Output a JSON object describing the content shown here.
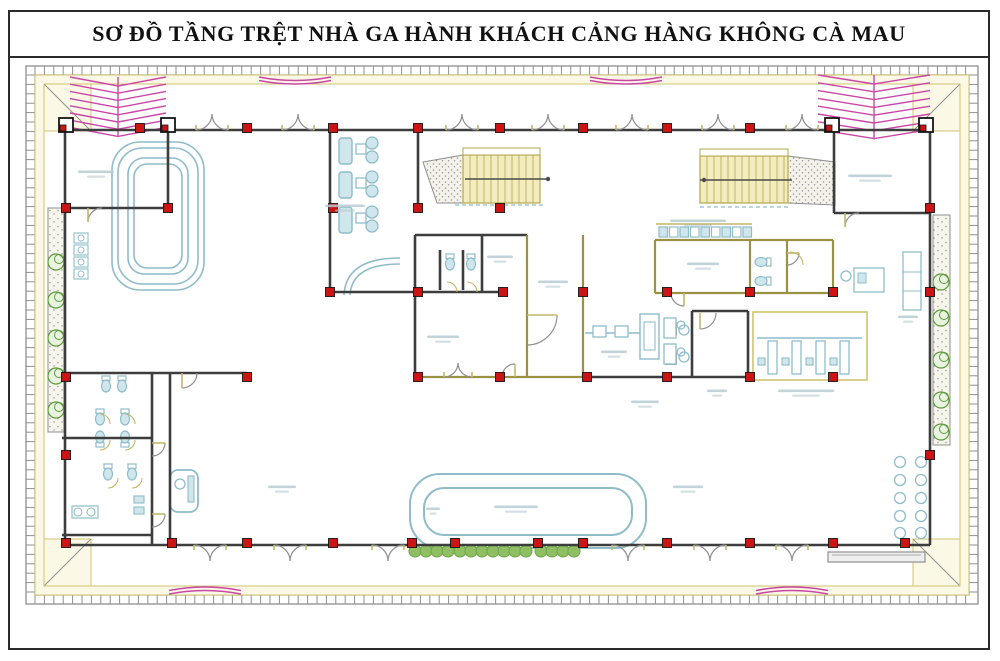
{
  "title": "SƠ ĐỒ TẦNG TRỆT NHÀ GA HÀNH KHÁCH CẢNG HÀNG KHÔNG CÀ MAU",
  "notes": {
    "room_labels_legible": false
  },
  "palette": {
    "ink": "#2b2b2b",
    "wall": "#3d3d3d",
    "wall_olive": "#9a9143",
    "column_fill": "#cc1414",
    "column_edge": "#151515",
    "furniture": "#8fbcc9",
    "furniture_fill": "#cfe6ec",
    "stair_fill": "#f2ecbe",
    "stair_edge": "#b3a74e",
    "cream_fill": "#fbf8e6",
    "cream_edge": "#cfc46e",
    "band_gray": "#8f8f8f",
    "canopy_pink": "#ca47a8",
    "plant_green": "#5d9a3c",
    "plant_fill": "#8fbe63",
    "shrub_green": "#6faa4a",
    "speckle_gray": "#9a9a9a",
    "door_gray": "#8f8f8f",
    "door_leaf": "#c2b86a",
    "label_smudge": "#b7ccd4"
  },
  "plan": {
    "band": {
      "outer": [
        26,
        66,
        952,
        538
      ],
      "thickness": 9,
      "tick_step": 9.4
    },
    "corner_boxes": [
      [
        35,
        75
      ],
      [
        913,
        75
      ],
      [
        35,
        539
      ],
      [
        913,
        539
      ]
    ],
    "cream_ring": {
      "outer": [
        35,
        75,
        934,
        520
      ],
      "inner": [
        44,
        84,
        916,
        502
      ]
    },
    "chevrons": [
      {
        "x1": 70,
        "x2": 166,
        "y0": 77,
        "rows": 8,
        "step": 7.2,
        "drop": 9
      },
      {
        "x1": 818,
        "x2": 930,
        "y0": 75,
        "rows": 8,
        "step": 7.8,
        "drop": 9
      }
    ],
    "pink_canopies": [
      {
        "cx": 295,
        "y": 77,
        "w": 72,
        "bulge": 7
      },
      {
        "cx": 626,
        "y": 77,
        "w": 72,
        "bulge": 7
      },
      {
        "cx": 205,
        "y": 594,
        "w": 72,
        "bulge": -7
      },
      {
        "cx": 792,
        "y": 594,
        "w": 72,
        "bulge": -7
      }
    ],
    "planters": [
      {
        "rect": [
          48,
          208,
          16,
          224
        ],
        "px": 56,
        "plant_ys": [
          262,
          300,
          338,
          376,
          410
        ]
      },
      {
        "rect": [
          933,
          215,
          17,
          230
        ],
        "px": 941,
        "plant_ys": [
          282,
          318,
          360,
          400,
          432
        ]
      }
    ],
    "shrub_rows": [
      {
        "x1": 415,
        "x2": 452,
        "y": 551
      },
      {
        "x1": 460,
        "x2": 533,
        "y": 551
      },
      {
        "x1": 541,
        "x2": 580,
        "y": 551
      }
    ],
    "walls_dark": [
      [
        65,
        130,
        930,
        130
      ],
      [
        65,
        545,
        930,
        545
      ],
      [
        65,
        130,
        65,
        545
      ],
      [
        930,
        130,
        930,
        545
      ],
      [
        168,
        130,
        168,
        208
      ],
      [
        65,
        208,
        168,
        208
      ],
      [
        330,
        130,
        330,
        292
      ],
      [
        418,
        130,
        418,
        208
      ],
      [
        330,
        292,
        503,
        292
      ],
      [
        415,
        235,
        527,
        235
      ],
      [
        415,
        235,
        415,
        377
      ],
      [
        482,
        235,
        482,
        292
      ],
      [
        440,
        250,
        440,
        290
      ],
      [
        463,
        250,
        463,
        290
      ],
      [
        62,
        373,
        247,
        373
      ],
      [
        152,
        373,
        152,
        545
      ],
      [
        170,
        373,
        170,
        545
      ],
      [
        62,
        438,
        152,
        438
      ],
      [
        62,
        535,
        152,
        535
      ],
      [
        834,
        130,
        834,
        213
      ],
      [
        834,
        213,
        930,
        213
      ],
      [
        692,
        311,
        692,
        377
      ],
      [
        748,
        311,
        748,
        377
      ],
      [
        692,
        311,
        748,
        311
      ],
      [
        587,
        377,
        748,
        377
      ]
    ],
    "walls_olive": [
      [
        527,
        235,
        527,
        377
      ],
      [
        583,
        235,
        583,
        377
      ],
      [
        415,
        377,
        587,
        377
      ],
      [
        655,
        240,
        833,
        240
      ],
      [
        655,
        240,
        655,
        293
      ],
      [
        750,
        240,
        750,
        293
      ],
      [
        787,
        240,
        787,
        293
      ],
      [
        833,
        240,
        833,
        293
      ],
      [
        655,
        293,
        833,
        293
      ]
    ],
    "yellow_box": [
      753,
      312,
      114,
      68
    ],
    "carousel_loops": [
      [
        112,
        142,
        92,
        148,
        28
      ],
      [
        118,
        148,
        80,
        136,
        24
      ],
      [
        128,
        158,
        60,
        116,
        16
      ],
      [
        134,
        164,
        48,
        104,
        13
      ]
    ],
    "canopy_loops": [
      [
        410,
        474,
        236,
        74,
        30
      ],
      [
        424,
        488,
        208,
        47,
        20
      ]
    ],
    "lounge_rail": [
      "M400,258 Q346,258 344,295",
      "M400,264 Q352,264 350,295"
    ],
    "stairs": [
      {
        "tread": [
          463,
          155,
          77,
          48
        ],
        "step": 7,
        "speck": "423,162 463,155 463,203 437,203",
        "rail": [
          465,
          179,
          548,
          179
        ],
        "dot": [
          548,
          179
        ],
        "top": [
          463,
          148,
          77,
          7
        ]
      },
      {
        "tread": [
          700,
          156,
          88,
          47
        ],
        "step": 7,
        "speck": "788,156 835,162 835,205 788,203",
        "rail": [
          700,
          180,
          792,
          180
        ],
        "dot": [
          704,
          180
        ],
        "top": [
          700,
          149,
          88,
          7
        ]
      }
    ],
    "stair_dash": [
      [
        455,
        205,
        545,
        205
      ],
      [
        700,
        207,
        790,
        207
      ]
    ],
    "doors_top": {
      "y": 130,
      "r": 16,
      "dir": -1,
      "xs": [
        212,
        298,
        462,
        548,
        632,
        718,
        802
      ]
    },
    "doors_bottom": {
      "y": 545,
      "r": 16,
      "dir": 1,
      "xs": [
        210,
        290,
        388,
        628,
        710,
        792
      ]
    },
    "doors_pair_internal": [
      {
        "cx": 458,
        "y": 377,
        "r": 14,
        "dir": -1
      }
    ],
    "doors_single": [
      {
        "d": "M88,222 A14,14 0 0,1 102,208",
        "leaf": "M88,208 L88,222"
      },
      {
        "d": "M845,227 A14,14 0 0,1 859,213",
        "leaf": "M845,213 L845,227"
      },
      {
        "d": "M684,306 A13,13 0 0,1 671,293",
        "leaf": "M684,293 L684,306"
      },
      {
        "d": "M557,315 A30,30 0 0,1 527,345",
        "leaf": "M527,315 L557,315"
      },
      {
        "d": "M700,329 A16,16 0 0,0 716,313",
        "leaf": "M700,313 L700,329"
      },
      {
        "d": "M515,364 A13,13 0 0,0 502,377",
        "leaf": "M515,377 L515,364"
      },
      {
        "d": "M165,443 A13,13 0 0,1 152,456",
        "leaf": "M152,443 L165,443"
      },
      {
        "d": "M165,514 A13,13 0 0,1 152,527",
        "leaf": "M152,514 L165,514"
      },
      {
        "d": "M182,388 A15,15 0 0,0 197,373",
        "leaf": "M182,373 L182,388"
      },
      {
        "d": "M799,253 A12,12 0 0,1 787,265",
        "leaf": "M787,253 L799,253"
      }
    ],
    "doors_pale": [
      "M100,414 A10,10 0 0,1 110,424",
      "M125,414 A10,10 0 0,1 135,424",
      "M100,450 A10,10 0 0,0 110,440",
      "M125,450 A10,10 0 0,0 135,440",
      "M108,488 A10,10 0 0,0 118,478",
      "M132,488 A10,10 0 0,0 142,478",
      "M447,282 A10,10 0 0,1 457,292",
      "M467,282 A10,10 0 0,1 477,292",
      "M790,252 A13,13 0 0,1 803,265"
    ],
    "columns": {
      "size": 9,
      "rows": [
        {
          "y": 128,
          "xs": [
            140,
            247,
            333,
            418,
            500,
            583,
            667,
            750
          ]
        },
        {
          "y": 208,
          "xs": [
            66,
            168,
            333,
            418,
            500,
            930
          ]
        },
        {
          "y": 292,
          "xs": [
            330,
            418,
            503,
            583,
            667,
            750,
            833,
            930
          ]
        },
        {
          "y": 377,
          "xs": [
            66,
            247,
            418,
            500,
            587,
            667,
            750,
            833
          ]
        },
        {
          "y": 455,
          "xs": [
            66,
            930
          ]
        },
        {
          "y": 543,
          "xs": [
            66,
            172,
            247,
            333,
            412,
            455,
            538,
            583,
            667,
            750,
            833,
            905
          ]
        }
      ]
    },
    "posts": [
      [
        66,
        125
      ],
      [
        168,
        125
      ],
      [
        832,
        125
      ],
      [
        926,
        125
      ]
    ],
    "lounge_rows": {
      "ys": [
        138,
        172,
        207
      ],
      "sofa": [
        339,
        13,
        26
      ],
      "table": [
        356,
        10
      ],
      "chairs_x": 372,
      "chair_r": 6
    },
    "chair_row": {
      "x0": 659,
      "y": 227,
      "n": 9,
      "w": 8.5,
      "h": 10,
      "gap": 10.5,
      "line_y": 224,
      "x1": 656,
      "x2": 752
    },
    "counters": {
      "line": [
        757,
        338,
        862,
        338
      ],
      "xs": [
        768,
        792,
        816,
        840
      ],
      "y": 341,
      "w": 9,
      "h": 33,
      "seat_xs": [
        758,
        782,
        806,
        830
      ],
      "seat_y": 358
    },
    "security": {
      "belt": [
        585,
        333,
        640,
        333
      ],
      "boxes": [
        [
          593,
          326,
          13,
          11
        ],
        [
          615,
          326,
          13,
          11
        ]
      ],
      "scanner": [
        640,
        314,
        19,
        45
      ],
      "scanner_in": [
        644,
        322,
        11,
        28
      ],
      "chairs": [
        [
          666,
          323,
          10,
          12
        ],
        [
          666,
          352,
          10,
          12
        ]
      ],
      "circles": [
        [
          684,
          330
        ],
        [
          684,
          357
        ]
      ]
    },
    "toilets": [
      [
        106,
        386,
        0
      ],
      [
        122,
        386,
        0
      ],
      [
        100,
        419,
        0
      ],
      [
        125,
        419,
        0
      ],
      [
        100,
        437,
        180
      ],
      [
        125,
        437,
        180
      ],
      [
        108,
        474,
        0
      ],
      [
        132,
        474,
        0
      ],
      [
        450,
        264,
        0
      ],
      [
        471,
        264,
        0
      ],
      [
        761,
        262,
        90
      ],
      [
        761,
        281,
        90
      ]
    ],
    "sink_strip": {
      "x": 74,
      "y0": 233,
      "n": 4,
      "dy": 12,
      "w": 14,
      "h": 10
    },
    "sink_counter": {
      "rect": [
        72,
        506,
        26,
        12
      ],
      "circles": [
        [
          78,
          512
        ],
        [
          91,
          512
        ]
      ]
    },
    "small_fixtures": [
      [
        134,
        496,
        10,
        7
      ],
      [
        134,
        507,
        10,
        7
      ]
    ],
    "wc_desk": {
      "rect": [
        170,
        470,
        28,
        42,
        8
      ],
      "circle": [
        180,
        484,
        5
      ],
      "bar": [
        188,
        476,
        6,
        26
      ]
    },
    "office_desks": {
      "rects": [
        [
          664,
          318,
          12,
          20
        ],
        [
          664,
          344,
          12,
          20
        ]
      ],
      "circles": [
        [
          681,
          325
        ],
        [
          681,
          352
        ]
      ]
    },
    "right_desk": {
      "circle": [
        846,
        276,
        5
      ],
      "rect": [
        854,
        268,
        30,
        24
      ],
      "glyph": [
        858,
        273,
        8,
        10
      ],
      "cabinet": [
        903,
        252,
        18,
        58
      ],
      "cab_lines": [
        272,
        291
      ]
    },
    "seat_circles": {
      "xs": [
        900,
        921
      ],
      "ys": [
        462,
        480,
        498,
        516,
        533
      ],
      "r": 5.5
    },
    "bench": [
      828,
      552,
      97,
      10
    ],
    "labels": [
      [
        96,
        172,
        36
      ],
      [
        345,
        206,
        40
      ],
      [
        500,
        257,
        26
      ],
      [
        553,
        282,
        30
      ],
      [
        443,
        337,
        32
      ],
      [
        645,
        402,
        28
      ],
      [
        703,
        264,
        32
      ],
      [
        698,
        221,
        56
      ],
      [
        717,
        391,
        20
      ],
      [
        806,
        391,
        56
      ],
      [
        870,
        176,
        44
      ],
      [
        688,
        487,
        30
      ],
      [
        282,
        487,
        28
      ],
      [
        516,
        507,
        44
      ],
      [
        908,
        317,
        20
      ],
      [
        614,
        352,
        26
      ],
      [
        433,
        509,
        14
      ]
    ]
  }
}
